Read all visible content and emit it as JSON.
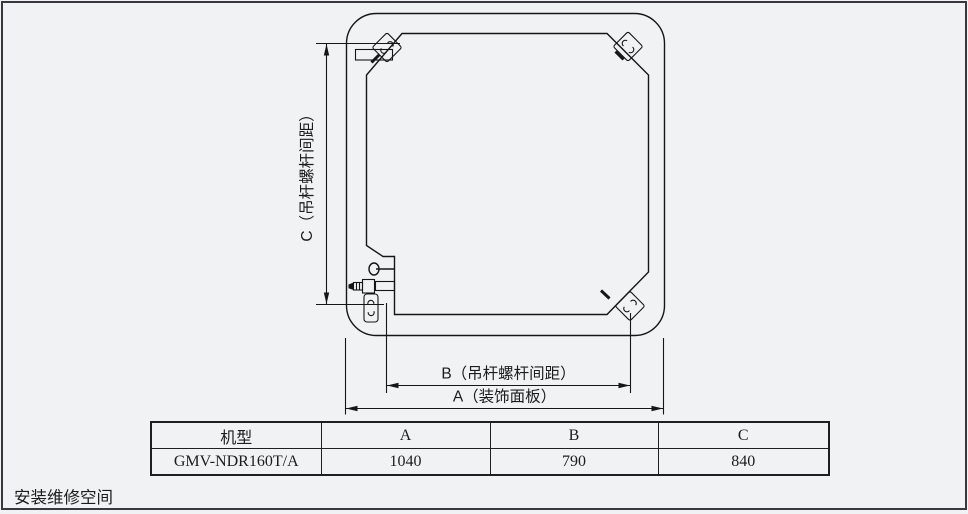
{
  "page": {
    "background_color": "#f0f2f4",
    "border_color": "#3b373e",
    "line_color": "#161616"
  },
  "diagram": {
    "kind": "indoor-unit-top-view-dimension-drawing",
    "dimension_labels": {
      "c": "C（吊杆螺杆间距）",
      "b": "B（吊杆螺杆间距）",
      "a": "A（装饰面板）"
    },
    "icons": {
      "hanger_bracket": "s-hook-bracket",
      "pipe_valve": "stem-valve-circle",
      "flare_fitting": "flare-nut-connector"
    }
  },
  "table": {
    "headers": [
      "机型",
      "A",
      "B",
      "C"
    ],
    "rows": [
      [
        "GMV-NDR160T/A",
        "1040",
        "790",
        "840"
      ]
    ]
  },
  "footer": {
    "note": "安装维修空间"
  }
}
